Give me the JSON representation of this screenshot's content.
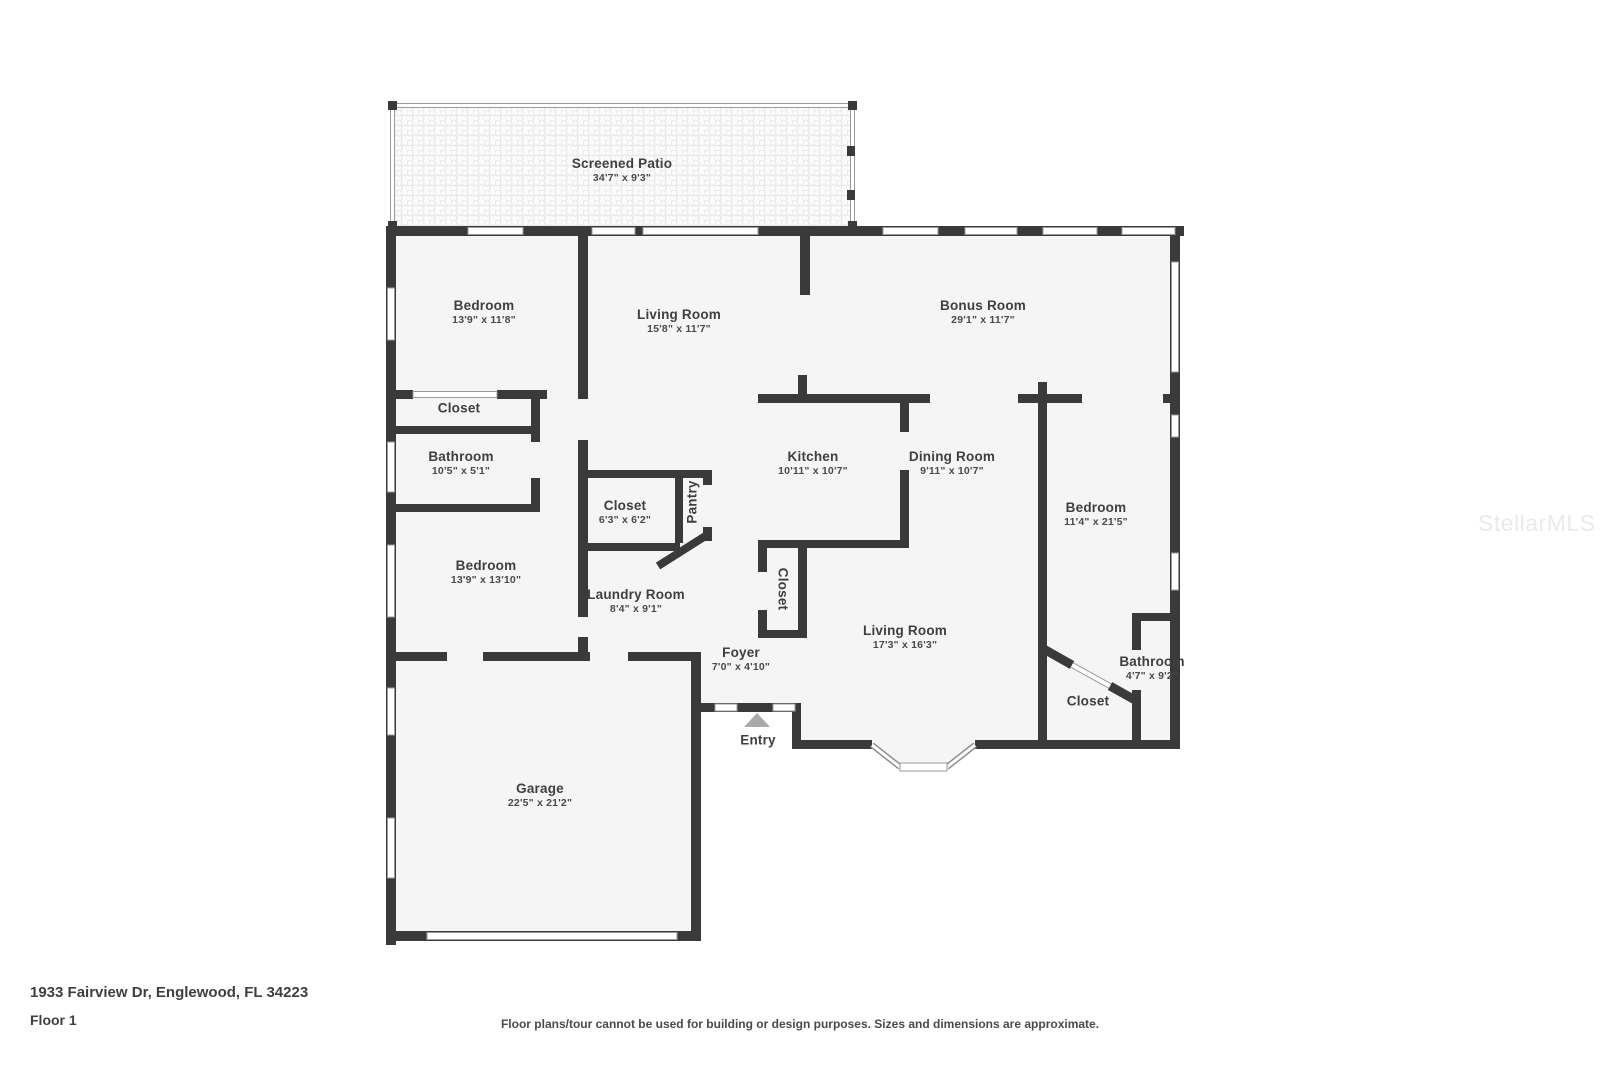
{
  "floorplan": {
    "rooms": {
      "screened_patio": {
        "name": "Screened Patio",
        "dims": "34'7\" x 9'3\""
      },
      "bedroom_top_left": {
        "name": "Bedroom",
        "dims": "13'9\" x 11'8\""
      },
      "living_room_top": {
        "name": "Living Room",
        "dims": "15'8\" x 11'7\""
      },
      "bonus_room": {
        "name": "Bonus Room",
        "dims": "29'1\" x 11'7\""
      },
      "closet_hall": {
        "name": "Closet",
        "dims": ""
      },
      "bathroom_left": {
        "name": "Bathroom",
        "dims": "10'5\" x 5'1\""
      },
      "closet_mid": {
        "name": "Closet",
        "dims": "6'3\" x 6'2\""
      },
      "pantry": {
        "name": "Pantry",
        "dims": ""
      },
      "kitchen": {
        "name": "Kitchen",
        "dims": "10'11\" x 10'7\""
      },
      "dining_room": {
        "name": "Dining Room",
        "dims": "9'11\" x 10'7\""
      },
      "bedroom_right": {
        "name": "Bedroom",
        "dims": "11'4\" x 21'5\""
      },
      "bedroom_left": {
        "name": "Bedroom",
        "dims": "13'9\" x 13'10\""
      },
      "laundry_room": {
        "name": "Laundry Room",
        "dims": "8'4\" x 9'1\""
      },
      "closet_foyer": {
        "name": "Closet",
        "dims": ""
      },
      "foyer": {
        "name": "Foyer",
        "dims": "7'0\" x 4'10\""
      },
      "entry": {
        "name": "Entry",
        "dims": ""
      },
      "living_room_main": {
        "name": "Living Room",
        "dims": "17'3\" x 16'3\""
      },
      "closet_back": {
        "name": "Closet",
        "dims": ""
      },
      "bathroom_right": {
        "name": "Bathroom",
        "dims": "4'7\" x 9'2\""
      },
      "garage": {
        "name": "Garage",
        "dims": "22'5\" x 21'2\""
      }
    },
    "footer": {
      "address": "1933 Fairview Dr, Englewood, FL 34223",
      "floor": "Floor 1",
      "disclaimer": "Floor plans/tour cannot be used for building or design purposes. Sizes and dimensions are approximate."
    },
    "watermark": "StellarMLS",
    "colors": {
      "wall": "#3a3a3a",
      "room_fill": "#f5f5f5",
      "text": "#414141"
    }
  }
}
